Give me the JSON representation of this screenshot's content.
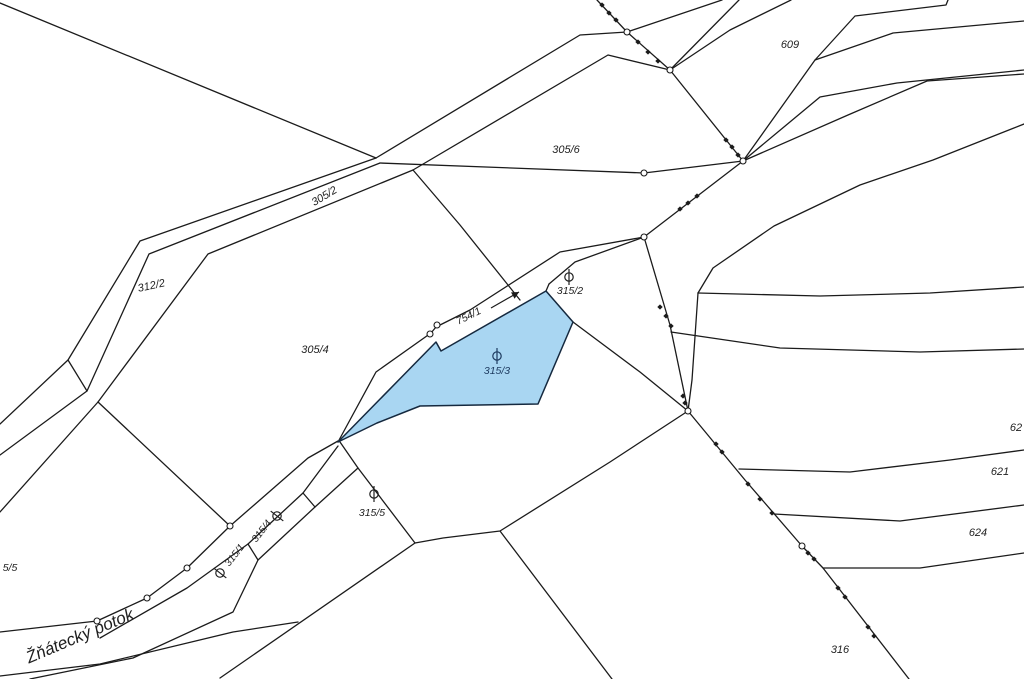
{
  "map": {
    "width": 1024,
    "height": 679,
    "stream_name": "Žňátecký potok",
    "highlighted_parcel": "315/3",
    "colors": {
      "background": "#ffffff",
      "boundary_line": "#1b1b1b",
      "label_text": "#1f1f1f",
      "water_fill": "#a9d6f2",
      "water_stroke": "#15293f",
      "water_label": "#1d3a5f",
      "marker_fill": "#ffffff"
    },
    "water_parcel_polygon": [
      [
        338,
        442
      ],
      [
        436,
        342
      ],
      [
        441,
        351
      ],
      [
        546,
        291
      ],
      [
        573,
        322
      ],
      [
        538,
        404
      ],
      [
        420,
        406
      ],
      [
        377,
        423
      ]
    ],
    "parcel_labels": [
      {
        "text": "305/2",
        "x": 326,
        "y": 199,
        "rot": -31,
        "size": 11,
        "color": "label_text"
      },
      {
        "text": "312/2",
        "x": 152,
        "y": 289,
        "rot": -12,
        "size": 11,
        "color": "label_text"
      },
      {
        "text": "305/4",
        "x": 315,
        "y": 353,
        "rot": 0,
        "size": 11,
        "color": "label_text"
      },
      {
        "text": "305/6",
        "x": 566,
        "y": 153,
        "rot": 0,
        "size": 11,
        "color": "label_text"
      },
      {
        "text": "609",
        "x": 790,
        "y": 48,
        "rot": 0,
        "size": 11,
        "color": "label_text"
      },
      {
        "text": "754/1",
        "x": 470,
        "y": 319,
        "rot": -26,
        "size": 10.5,
        "color": "label_text"
      },
      {
        "text": "315/2",
        "x": 570,
        "y": 294,
        "rot": 0,
        "size": 10.5,
        "color": "label_text"
      },
      {
        "text": "315/3",
        "x": 497,
        "y": 374,
        "rot": 0,
        "size": 10.5,
        "color": "water_label"
      },
      {
        "text": "315/5",
        "x": 372,
        "y": 516,
        "rot": 0,
        "size": 10.5,
        "color": "label_text"
      },
      {
        "text": "315/1",
        "x": 237,
        "y": 557,
        "rot": -52,
        "size": 10,
        "color": "label_text"
      },
      {
        "text": "315/4",
        "x": 264,
        "y": 533,
        "rot": -52,
        "size": 10,
        "color": "label_text"
      },
      {
        "text": "316",
        "x": 840,
        "y": 653,
        "rot": 0,
        "size": 11,
        "color": "label_text"
      },
      {
        "text": "62",
        "x": 1016,
        "y": 431,
        "rot": 0,
        "size": 11,
        "color": "label_text"
      },
      {
        "text": "621",
        "x": 1000,
        "y": 475,
        "rot": 0,
        "size": 11,
        "color": "label_text"
      },
      {
        "text": "624",
        "x": 978,
        "y": 536,
        "rot": 0,
        "size": 11,
        "color": "label_text"
      },
      {
        "text": "5/5",
        "x": 10,
        "y": 571,
        "rot": 0,
        "size": 10.5,
        "color": "label_text"
      }
    ],
    "stream_label": {
      "text": "Žňátecký potok",
      "x": 82,
      "y": 641,
      "rot": -23,
      "size": 17,
      "color": "label_text"
    },
    "land_use_symbols": [
      {
        "name": "grassland-symbol",
        "x": 569,
        "y": 277,
        "rot": 0,
        "color": "label_text"
      },
      {
        "name": "grassland-symbol",
        "x": 497,
        "y": 356,
        "rot": 0,
        "color": "water_label"
      },
      {
        "name": "grassland-symbol",
        "x": 374,
        "y": 494,
        "rot": 0,
        "color": "label_text"
      },
      {
        "name": "grassland-symbol",
        "x": 277,
        "y": 516,
        "rot": -52,
        "color": "label_text"
      },
      {
        "name": "grassland-symbol",
        "x": 220,
        "y": 573,
        "rot": -52,
        "color": "label_text"
      }
    ],
    "flow_arrow": {
      "x1": 491,
      "y1": 308,
      "x2": 519,
      "y2": 292
    },
    "boundary_lines": [
      {
        "name": "triangle-hypotenuse",
        "pts": [
          [
            0,
            3
          ],
          [
            376,
            158
          ]
        ]
      },
      {
        "name": "strip-nw-edge",
        "pts": [
          [
            0,
            424
          ],
          [
            68,
            360
          ],
          [
            140,
            241
          ],
          [
            376,
            158
          ]
        ]
      },
      {
        "name": "strip-divider-312",
        "pts": [
          [
            68,
            360
          ],
          [
            87,
            391
          ]
        ]
      },
      {
        "name": "strip-se-edge",
        "pts": [
          [
            0,
            455
          ],
          [
            87,
            391
          ],
          [
            149,
            254
          ],
          [
            380,
            163
          ]
        ]
      },
      {
        "name": "parcel-305-6-south",
        "pts": [
          [
            380,
            163
          ],
          [
            644,
            173
          ],
          [
            743,
            161
          ]
        ]
      },
      {
        "name": "road-se-edge",
        "pts": [
          [
            0,
            512
          ],
          [
            98,
            402
          ],
          [
            208,
            254
          ],
          [
            413,
            170
          ],
          [
            608,
            55
          ],
          [
            670,
            70
          ]
        ]
      },
      {
        "name": "road-nw-edge",
        "pts": [
          [
            376,
            158
          ],
          [
            580,
            35
          ],
          [
            627,
            32
          ],
          [
            722,
            0
          ]
        ]
      },
      {
        "name": "branch-to-stream",
        "pts": [
          [
            98,
            402
          ],
          [
            230,
            526
          ]
        ]
      },
      {
        "name": "parcel-305-6-west",
        "pts": [
          [
            413,
            170
          ],
          [
            460,
            225
          ],
          [
            520,
            300
          ]
        ]
      },
      {
        "name": "marked-boundary",
        "pts": [
          [
            597,
            0
          ],
          [
            627,
            32
          ],
          [
            670,
            70
          ],
          [
            743,
            161
          ],
          [
            644,
            237
          ],
          [
            670,
            325
          ],
          [
            688,
            411
          ],
          [
            745,
            480
          ],
          [
            802,
            546
          ],
          [
            823,
            568
          ],
          [
            909,
            679
          ]
        ]
      },
      {
        "name": "wedge-line-1",
        "pts": [
          [
            670,
            70
          ],
          [
            739,
            0
          ]
        ]
      },
      {
        "name": "wedge-line-2",
        "pts": [
          [
            670,
            70
          ],
          [
            730,
            30
          ],
          [
            791,
            0
          ]
        ]
      },
      {
        "name": "parcel-609-south",
        "pts": [
          [
            743,
            161
          ],
          [
            815,
            60
          ],
          [
            855,
            16
          ],
          [
            946,
            5
          ],
          [
            948,
            0
          ]
        ]
      },
      {
        "name": "terrace-sweep-1",
        "pts": [
          [
            815,
            60
          ],
          [
            893,
            33
          ],
          [
            1024,
            21
          ]
        ]
      },
      {
        "name": "terrace-sweep-2",
        "pts": [
          [
            743,
            161
          ],
          [
            820,
            97
          ],
          [
            897,
            83
          ],
          [
            1024,
            70
          ]
        ]
      },
      {
        "name": "terrace-sweep-3",
        "pts": [
          [
            743,
            161
          ],
          [
            848,
            115
          ],
          [
            927,
            81
          ],
          [
            1024,
            74
          ]
        ]
      },
      {
        "name": "terrace-sweep-4",
        "pts": [
          [
            698,
            293
          ],
          [
            713,
            268
          ],
          [
            774,
            226
          ],
          [
            860,
            185
          ],
          [
            933,
            160
          ],
          [
            1024,
            124
          ]
        ]
      },
      {
        "name": "terrace-line-0",
        "pts": [
          [
            698,
            293
          ],
          [
            820,
            296
          ],
          [
            930,
            293
          ],
          [
            1024,
            287
          ]
        ]
      },
      {
        "name": "terrace-stub",
        "pts": [
          [
            698,
            293
          ],
          [
            692,
            380
          ],
          [
            688,
            411
          ]
        ]
      },
      {
        "name": "terrace-line-2",
        "pts": [
          [
            671,
            332
          ],
          [
            780,
            348
          ],
          [
            920,
            352
          ],
          [
            1024,
            349
          ]
        ]
      },
      {
        "name": "terrace-line-3",
        "pts": [
          [
            739,
            469
          ],
          [
            850,
            472
          ],
          [
            950,
            460
          ],
          [
            1024,
            450
          ]
        ]
      },
      {
        "name": "terrace-line-4",
        "pts": [
          [
            774,
            514
          ],
          [
            900,
            521
          ],
          [
            1024,
            505
          ]
        ]
      },
      {
        "name": "terrace-line-5",
        "pts": [
          [
            823,
            568
          ],
          [
            920,
            568
          ],
          [
            1024,
            553
          ]
        ]
      },
      {
        "name": "long-south-boundary",
        "pts": [
          [
            688,
            411
          ],
          [
            610,
            462
          ],
          [
            500,
            531
          ],
          [
            443,
            538
          ],
          [
            415,
            543
          ],
          [
            220,
            678
          ]
        ]
      },
      {
        "name": "parcel-316-west",
        "pts": [
          [
            500,
            531
          ],
          [
            612,
            679
          ]
        ]
      },
      {
        "name": "stream-nw-edge",
        "pts": [
          [
            644,
            237
          ],
          [
            560,
            252
          ],
          [
            470,
            310
          ],
          [
            436,
            327
          ],
          [
            431,
            333
          ],
          [
            376,
            372
          ],
          [
            338,
            442
          ]
        ]
      },
      {
        "name": "stream-se-upper",
        "pts": [
          [
            644,
            237
          ],
          [
            575,
            262
          ],
          [
            549,
            284
          ]
        ]
      },
      {
        "name": "divider-315-2",
        "pts": [
          [
            549,
            284
          ],
          [
            546,
            291
          ]
        ]
      },
      {
        "name": "boundary-east-of-blue",
        "pts": [
          [
            573,
            322
          ],
          [
            640,
            372
          ],
          [
            688,
            411
          ]
        ]
      },
      {
        "name": "stream-bank-circles",
        "pts": [
          [
            0,
            632
          ],
          [
            97,
            621
          ],
          [
            147,
            598
          ],
          [
            187,
            568
          ],
          [
            230,
            526
          ],
          [
            308,
            458
          ],
          [
            338,
            441
          ]
        ]
      },
      {
        "name": "strip-315-upper",
        "pts": [
          [
            100,
            638
          ],
          [
            187,
            588
          ],
          [
            248,
            544
          ],
          [
            303,
            493
          ],
          [
            338,
            446
          ]
        ]
      },
      {
        "name": "strip-315-lower",
        "pts": [
          [
            30,
            679
          ],
          [
            133,
            658
          ],
          [
            233,
            612
          ],
          [
            258,
            560
          ],
          [
            315,
            507
          ],
          [
            358,
            468
          ]
        ]
      },
      {
        "name": "stream-south-edge",
        "pts": [
          [
            0,
            676
          ],
          [
            100,
            664
          ],
          [
            233,
            632
          ],
          [
            298,
            622
          ]
        ]
      },
      {
        "name": "divider-315-1-4",
        "pts": [
          [
            248,
            544
          ],
          [
            258,
            560
          ]
        ]
      },
      {
        "name": "divider-315-4-end",
        "pts": [
          [
            303,
            493
          ],
          [
            315,
            507
          ]
        ]
      },
      {
        "name": "parcel-315-5-west",
        "pts": [
          [
            340,
            442
          ],
          [
            358,
            468
          ],
          [
            415,
            543
          ]
        ]
      }
    ],
    "boundary_point_circles": [
      [
        627,
        32
      ],
      [
        670,
        70
      ],
      [
        743,
        161
      ],
      [
        644,
        237
      ],
      [
        688,
        411
      ],
      [
        802,
        546
      ],
      [
        644,
        173
      ],
      [
        437,
        325
      ],
      [
        430,
        334
      ],
      [
        97,
        621
      ],
      [
        147,
        598
      ],
      [
        187,
        568
      ],
      [
        230,
        526
      ]
    ],
    "boundary_point_dots": [
      [
        602,
        5
      ],
      [
        609,
        13
      ],
      [
        616,
        20
      ],
      [
        638,
        42
      ],
      [
        648,
        52
      ],
      [
        658,
        61
      ],
      [
        726,
        140
      ],
      [
        732,
        147
      ],
      [
        738,
        155
      ],
      [
        697,
        196
      ],
      [
        688,
        203
      ],
      [
        680,
        209
      ],
      [
        660,
        307
      ],
      [
        666,
        316
      ],
      [
        671,
        326
      ],
      [
        683,
        396
      ],
      [
        685,
        403
      ],
      [
        716,
        444
      ],
      [
        722,
        452
      ],
      [
        748,
        484
      ],
      [
        760,
        499
      ],
      [
        772,
        513
      ],
      [
        808,
        553
      ],
      [
        814,
        559
      ],
      [
        838,
        588
      ],
      [
        845,
        597
      ],
      [
        868,
        627
      ],
      [
        874,
        636
      ]
    ]
  }
}
